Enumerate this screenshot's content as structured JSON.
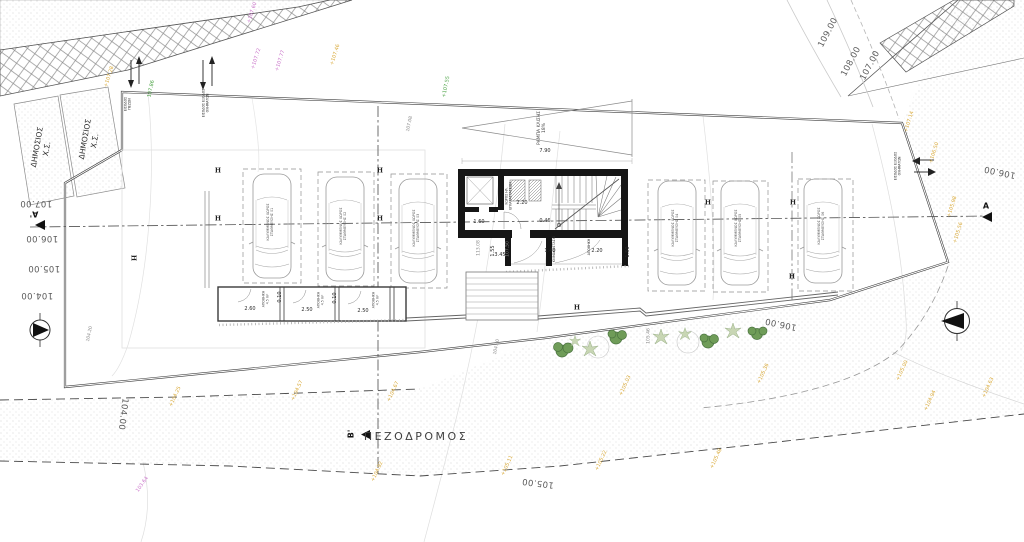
{
  "texts": {
    "pedestrian": "ΠΕΖΟΔΡΟΜΟΣ",
    "ramp": "ΡΑΜΠΑ ΚΛΙΣΗΣ\n18%",
    "parcel1": "ΔΗΜΟΣΙΟΣ\nΧ.Σ.",
    "parcel2": "ΔΗΜΟΣΙΟΣ\nΧ.Σ.",
    "entrance_pedestrian": "ΕΙΣΟΔΟΣ\nΠΕΖΩΝ",
    "entrance_vehicles_left": "ΕΙΣΟΔΟΣ ΕΞΟΔΟΣ\nΟΧΗΜΑΤΩΝ",
    "entrance_vehicles_right": "ΕΙΣΟΔΟΣ ΕΞΟΔΟΣ\nΟΧΗΜΑΤΩΝ",
    "elec_room": "ΧΩΡΟΣ ΗΛ.\nΕΓΚΑΤΑΣΤΑΣΕΩΝ",
    "stair_label": "ΚΛΙΜΑΚΟΣΤΑΣΙΟ",
    "store_label": "ΑΠΟΘΗΚΗ"
  },
  "sections": {
    "a_left": "Α'",
    "a_right": "Α",
    "b_bottom": "Β'"
  },
  "markers": {
    "h": "H"
  },
  "colors": {
    "yellow": "#d9a937",
    "green": "#4aa243",
    "magenta": "#c973c9",
    "wall": "#161616"
  },
  "contours": [
    {
      "v": "109.00"
    },
    {
      "v": "108.00"
    },
    {
      "v": "107.00"
    },
    {
      "v": "107.00"
    },
    {
      "v": "106.00"
    },
    {
      "v": "105.00"
    },
    {
      "v": "104.00"
    },
    {
      "v": "104.00"
    },
    {
      "v": "105.00"
    },
    {
      "v": "106.00"
    },
    {
      "v": "106.00"
    }
  ],
  "spots_yellow": [
    {
      "v": "+107.28"
    },
    {
      "v": "+107.46"
    },
    {
      "v": "+107.14"
    },
    {
      "v": "+106.50"
    },
    {
      "v": "+105.98"
    },
    {
      "v": "+105.56"
    },
    {
      "v": "+104.25"
    },
    {
      "v": "+104.57"
    },
    {
      "v": "+104.67"
    },
    {
      "v": "+104.92"
    },
    {
      "v": "+105.11"
    },
    {
      "v": "+105.22"
    },
    {
      "v": "+105.48"
    },
    {
      "v": "+105.03"
    },
    {
      "v": "+105.36"
    },
    {
      "v": "+105.00"
    },
    {
      "v": "+104.94"
    },
    {
      "v": "+104.63"
    }
  ],
  "spots_green": [
    {
      "v": "107.86"
    },
    {
      "v": "+107.55"
    }
  ],
  "spots_magenta": [
    {
      "v": "+107.60"
    },
    {
      "v": "+107.72"
    },
    {
      "v": "+107.77"
    },
    {
      "v": "103.64"
    }
  ],
  "spots_gray": [
    {
      "v": "107.08"
    },
    {
      "v": "104.20"
    },
    {
      "v": "105.46"
    },
    {
      "v": "104.30"
    },
    {
      "v": "113.08"
    },
    {
      "v": "107.50"
    }
  ],
  "dims": [
    {
      "v": "7.90"
    },
    {
      "v": "2.20"
    },
    {
      "v": "0.46"
    },
    {
      "v": "1.60"
    },
    {
      "v": "3.45"
    },
    {
      "v": "1.40"
    },
    {
      "v": "2.20"
    },
    {
      "v": "2.60"
    },
    {
      "v": "2.50"
    },
    {
      "v": "2.50"
    },
    {
      "v": "0.10"
    },
    {
      "v": "0.10"
    },
    {
      "v": "1.55"
    },
    {
      "v": "1.50"
    }
  ],
  "parking": [
    {
      "label": "ΚΑΛΥΜΜΕΝΟΣ ΧΩΡΟΣ\nΣΤΑΘΜΕΥΣΗΣ 01"
    },
    {
      "label": "ΚΑΛΥΜΜΕΝΟΣ ΧΩΡΟΣ\nΣΤΑΘΜΕΥΣΗΣ 02"
    },
    {
      "label": "ΚΑΛΥΜΜΕΝΟΣ ΧΩΡΟΣ\nΣΤΑΘΜΕΥΣΗΣ 03"
    },
    {
      "label": "ΚΑΛΥΜΜΕΝΟΣ ΧΩΡΟΣ\nΣΤΑΘΜΕΥΣΗΣ 04"
    },
    {
      "label": "ΚΑΛΥΜΜΕΝΟΣ ΧΩΡΟΣ\nΣΤΑΘΜΕΥΣΗΣ 05"
    },
    {
      "label": "ΚΑΛΥΜΜΕΝΟΣ ΧΩΡΟΣ\nΣΤΑΘΜΕΥΣΗΣ 06"
    }
  ],
  "storage": [
    {
      "label": "ΑΠΟΘΗΚΗ\n4.5 m²"
    },
    {
      "label": "ΑΠΟΘΗΚΗ\n4.5 m²"
    },
    {
      "label": "ΑΠΟΘΗΚΗ\n4.5 m²"
    }
  ]
}
